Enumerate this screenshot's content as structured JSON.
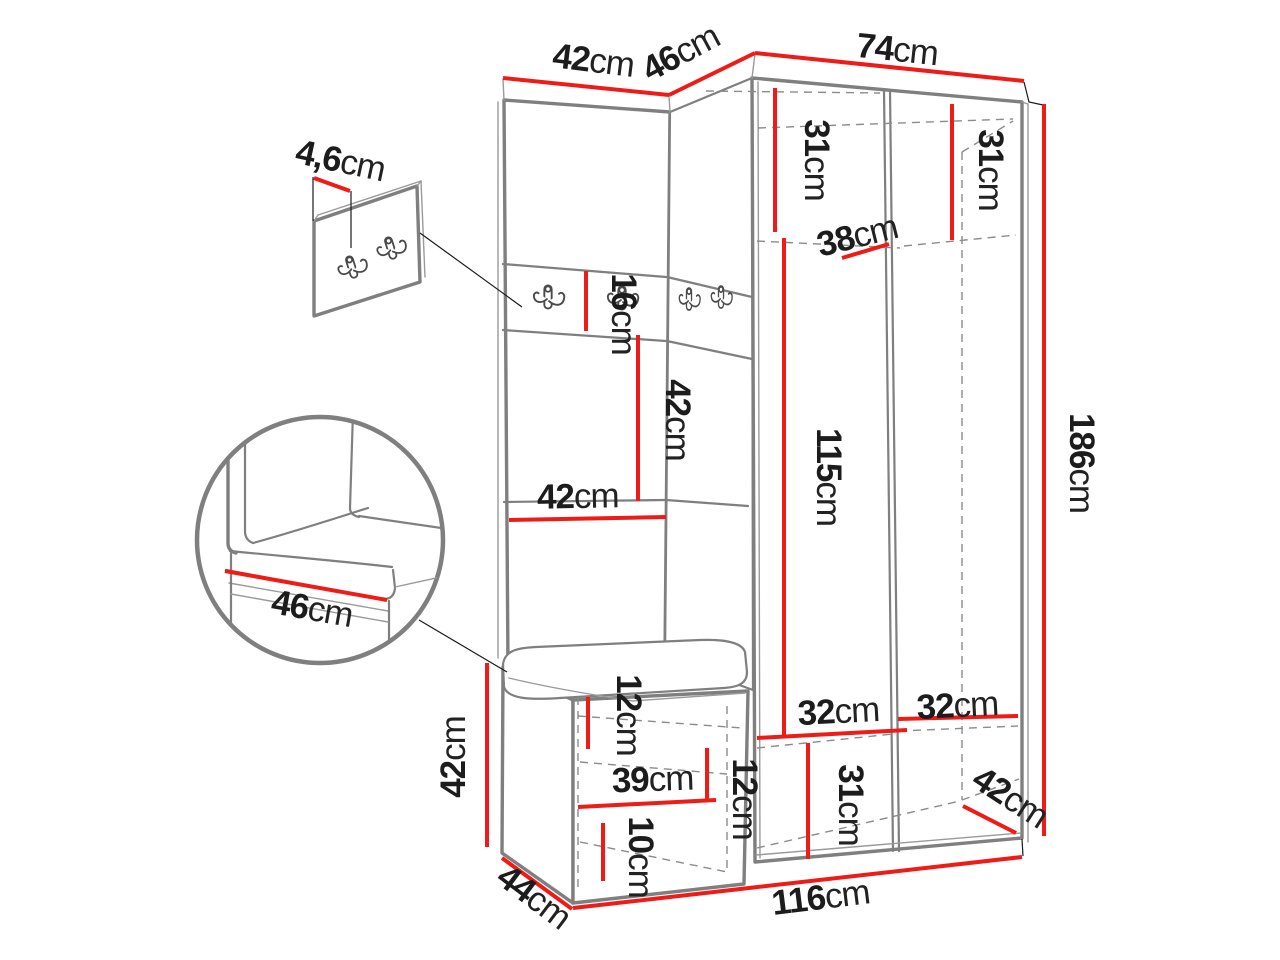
{
  "diagram": {
    "kind": "furniture-dimension-diagram",
    "subject": "corner hallway wardrobe with hook panel, bench and detail views",
    "background_color": "#ffffff",
    "line_color": "#7f7f7f",
    "dimension_line_color": "#ee1b17",
    "text_color": "#1c1c1c"
  },
  "icons": {
    "coat_hook": "double-coat-hook"
  },
  "dimensions": {
    "top_width_left": {
      "value": "42",
      "unit": "cm"
    },
    "top_width_middle": {
      "value": "46",
      "unit": "cm"
    },
    "top_width_right": {
      "value": "74",
      "unit": "cm"
    },
    "panel_thickness": {
      "value": "4,6",
      "unit": "cm"
    },
    "interior_left_height": {
      "value": "31",
      "unit": "cm"
    },
    "interior_right_height": {
      "value": "31",
      "unit": "cm"
    },
    "shelf_depth": {
      "value": "38",
      "unit": "cm"
    },
    "hook_strip_height": {
      "value": "16",
      "unit": "cm"
    },
    "back_panel_height": {
      "value": "42",
      "unit": "cm"
    },
    "back_panel_width": {
      "value": "42",
      "unit": "cm"
    },
    "door_height": {
      "value": "115",
      "unit": "cm"
    },
    "total_height": {
      "value": "186",
      "unit": "cm"
    },
    "seat_depth_detail": {
      "value": "46",
      "unit": "cm"
    },
    "bench_height": {
      "value": "42",
      "unit": "cm"
    },
    "bench_depth": {
      "value": "44",
      "unit": "cm"
    },
    "bench_top_inset": {
      "value": "12",
      "unit": "cm"
    },
    "bench_shelf_width": {
      "value": "39",
      "unit": "cm"
    },
    "bench_right_inset": {
      "value": "12",
      "unit": "cm"
    },
    "bench_bottom_height": {
      "value": "10",
      "unit": "cm"
    },
    "bottom_section_height": {
      "value": "31",
      "unit": "cm"
    },
    "bottom_left_width": {
      "value": "32",
      "unit": "cm"
    },
    "bottom_right_width": {
      "value": "32",
      "unit": "cm"
    },
    "bottom_side_depth": {
      "value": "42",
      "unit": "cm"
    },
    "total_width": {
      "value": "116",
      "unit": "cm"
    }
  }
}
